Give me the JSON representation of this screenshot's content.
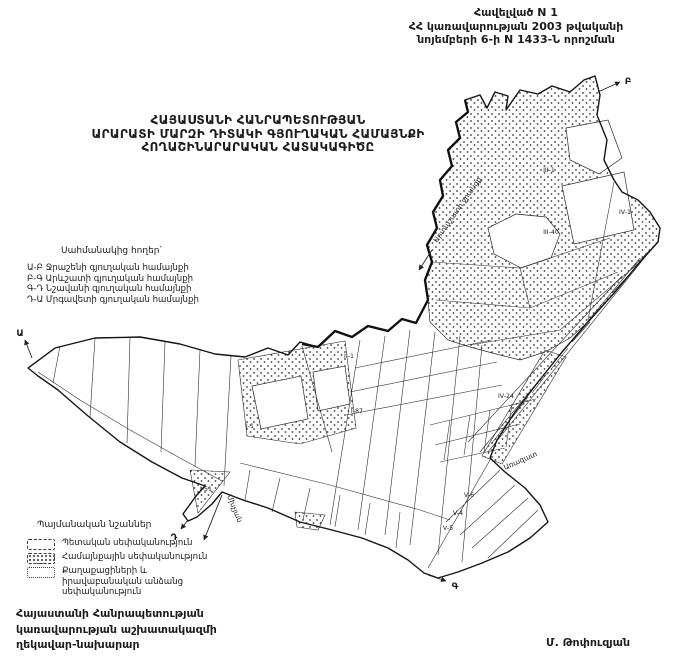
{
  "colors": {
    "ink": "#1c1c1c",
    "paper": "#ffffff"
  },
  "appendix": {
    "line1": "Հավելված N 1",
    "line2": "ՀՀ կառավարության 2003 թվականի",
    "line3": "նոյեմբերի 6-ի N 1433-Ն որոշման"
  },
  "title": {
    "line1": "ՀԱՅԱՍՏԱՆԻ ՀԱՆՐԱՊԵՏՈՒԹՅԱՆ",
    "line2": "ԱՐԱՐԱՏԻ ՄԱՐԶԻ ԴԻՏԱԿԻ ԳՅՈՒՂԱԿԱՆ ՀԱՄԱՅՆՔԻ",
    "line3": "ՀՈՂԱՇԻՆԱՐԱՐԱԿԱՆ ՀԱՏԱԿԱԳԻԾԸ"
  },
  "adjacent_lands": {
    "heading": "Սահմանակից հողեր՝",
    "items": [
      "Ա-Բ Ջրաշենի գյուղական համայնքի",
      "Բ-Գ Արևշատի գյուղական համայնքի",
      "Գ-Դ Նշավանի գյուղական համայնքի",
      "Դ-Ա Մրգավետի գյուղական համայնքի"
    ]
  },
  "legend": {
    "heading": "Պայմանական նշաններ",
    "items": [
      {
        "swatch": "state-white",
        "label": "Պետական սեփականություն"
      },
      {
        "swatch": "community-dotted",
        "label": "Համայնքային սեփականություն"
      },
      {
        "swatch": "private-white",
        "label": "Քաղաքացիների և իրավաբանական անձանց սեփականություն"
      }
    ]
  },
  "map": {
    "canal_label": "Արտաշատի ջրանցք",
    "road_label": "Առազատ",
    "town_label": "Մխչյան",
    "boundary_points": {
      "A": "Ա",
      "B": "Բ",
      "C": "Գ",
      "D": "Դ"
    },
    "parcels": {
      "p1": "III-1",
      "p2": "III-40",
      "p3": "IV-1",
      "p4": "IV-24",
      "p5": "II-1",
      "p6": "I-87",
      "p7": "I-1",
      "p8": "I-51",
      "p9": "V-6",
      "p10": "V-4",
      "p11": "V-5"
    }
  },
  "footer": {
    "line1": "Հայաստանի Հանրապետության",
    "line2": "կառավարության աշխատակազմի",
    "line3": "ղեկավար-նախարար",
    "signature": "Մ. Թոփուզյան"
  }
}
